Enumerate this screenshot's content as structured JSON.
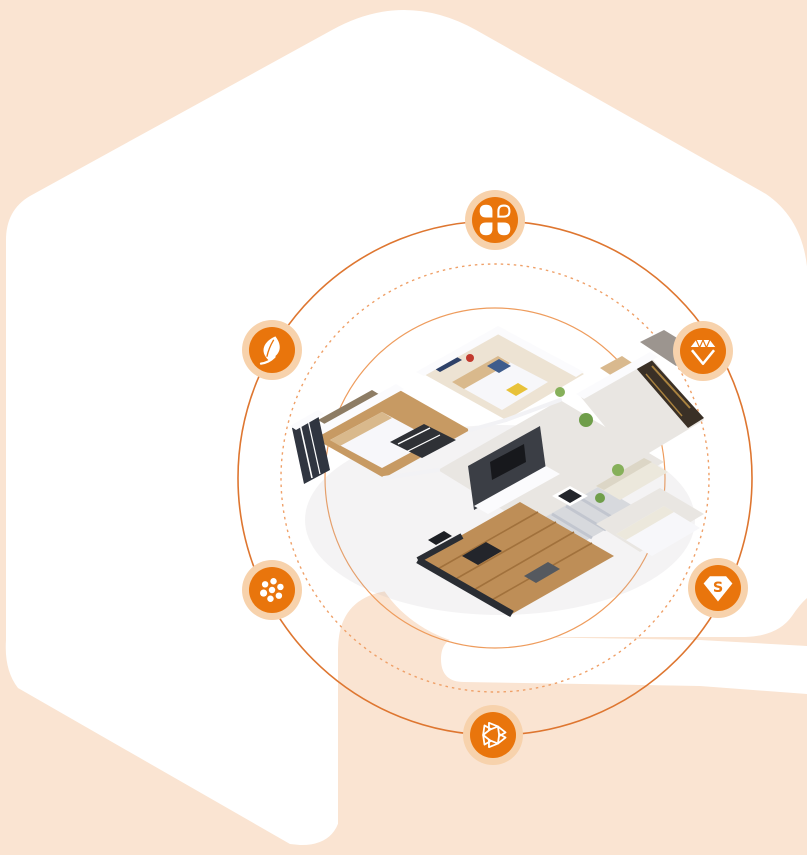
{
  "meta": {
    "description": "Landing-page hero graphic: isometric 3D apartment floor plan on a white faceted backdrop, ringed by orbit lines with six orange feature badges",
    "canvas_width": 807,
    "canvas_height": 855
  },
  "colors": {
    "peach": "#fae4d2",
    "white": "#ffffff",
    "badge_orange": "#e9750c",
    "badge_halo": "#f7d2ac",
    "ring_outer": "#de7630",
    "ring_dashed": "#efa068",
    "ring_inner": "#ee9c5d",
    "glyph_white": "#ffffff",
    "house_shadow": "#b8b3bd",
    "floor_beige": "#ede3d3",
    "floor_wood": "#c79a63",
    "floor_tile": "#e9e6e2",
    "deck_wood": "#be8e57",
    "deck_line": "#a1713c",
    "wall_white": "#fbfbfd",
    "wall_gray": "#d8dadf",
    "panel_brown": "#8d7c64",
    "dark_unit": "#2f3136",
    "tv_wall": "#3b3e45",
    "window_dark": "#303540",
    "shelf_dark": "#3a3026",
    "door_tan": "#d9b98e",
    "wall_texture": "#9c958f",
    "bed_white": "#f7f7fa",
    "pillow_tan": "#d9b98c",
    "accent_blue": "#3e5c8c",
    "accent_navy": "#2e4168",
    "accent_yellow": "#e8c23a",
    "accent_red": "#c23a2e",
    "sofa_cream": "#ece8dc",
    "rug_gray": "#d7d9dd",
    "rug_stripe": "#c2c6cf",
    "plant_green": "#6f9e4a",
    "plant_light": "#86b05a"
  },
  "orbits": {
    "center_x": 495,
    "center_y": 478,
    "inner_radius": 170,
    "dashed_radius": 214,
    "outer_radius": 257
  },
  "badges": [
    {
      "id": "clover",
      "icon": "clover-petals-icon",
      "position": "top"
    },
    {
      "id": "leaf",
      "icon": "leaf-icon",
      "position": "upper-left"
    },
    {
      "id": "gem",
      "icon": "diamond-gem-icon",
      "position": "upper-right"
    },
    {
      "id": "dots",
      "icon": "dot-flower-icon",
      "position": "lower-left"
    },
    {
      "id": "sgem",
      "icon": "s-gem-icon",
      "position": "lower-right"
    },
    {
      "id": "triangles",
      "icon": "triangle-ring-icon",
      "position": "bottom"
    }
  ],
  "sgem": {
    "letter": "S"
  }
}
